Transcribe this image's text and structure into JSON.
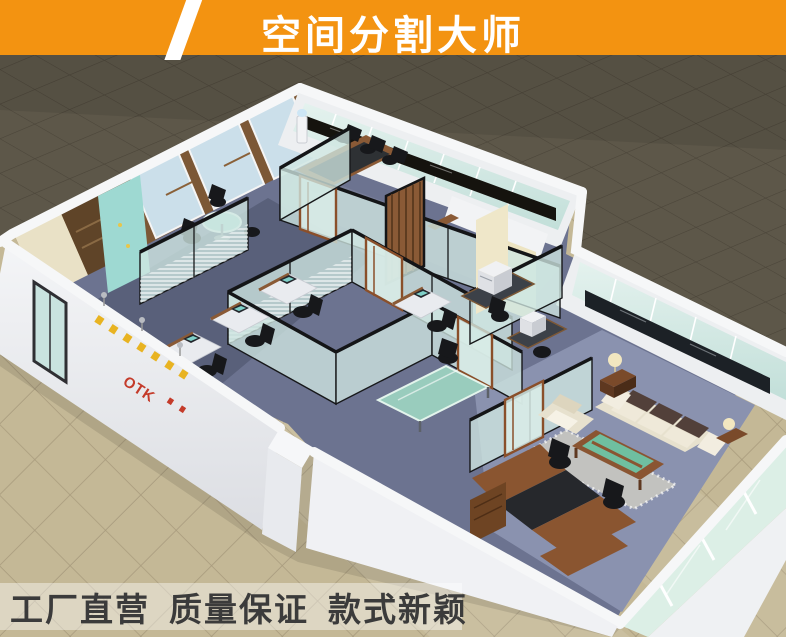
{
  "banner": {
    "title": "空间分割大师",
    "background": "#F39311",
    "slash_color": "#FFFFFF",
    "text_color": "#FFFFFF"
  },
  "slogans": {
    "items": [
      "工厂直营",
      "质量保证",
      "款式新颖"
    ],
    "text_color": "#3B3B3B"
  },
  "scene": {
    "logo": "OTK",
    "colors": {
      "dark_floor": "#5D5749",
      "light_floor": "#C4B896",
      "wall_white": "#F1F2F4",
      "glass": "#CFE7E2",
      "partition_frame": "#17181A",
      "wood": "#7C5836",
      "carpet": "#6C7390",
      "exec_carpet": "#8A92AF",
      "sofa": "#E7E1CE",
      "sofa_cushion": "#52403A",
      "coffee_table_glass": "#6FBFA0",
      "marble_sill": "#15130E"
    }
  }
}
